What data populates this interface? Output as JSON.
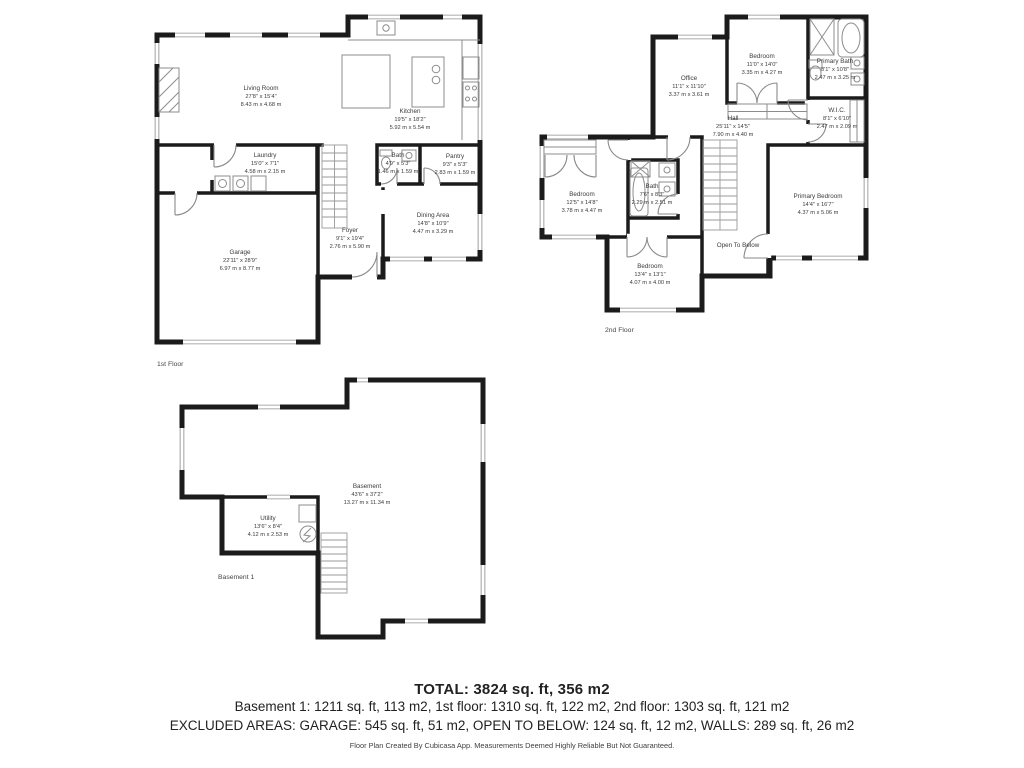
{
  "page": {
    "background": "#ffffff",
    "wall_color": "#1b1b1b",
    "fixture_color": "#8c8c8c",
    "text_color": "#3b3b3b"
  },
  "floors": {
    "first": {
      "label": "1st Floor",
      "rooms": {
        "living_room": {
          "name": "Living Room",
          "imperial": "27'8\" x 15'4\"",
          "metric": "8.43 m x 4.68 m"
        },
        "kitchen": {
          "name": "Kitchen",
          "imperial": "19'5\" x 18'2\"",
          "metric": "5.92 m x 5.54 m"
        },
        "laundry": {
          "name": "Laundry",
          "imperial": "15'0\" x 7'1\"",
          "metric": "4.58 m x 2.15 m"
        },
        "bath": {
          "name": "Bath",
          "imperial": "4'9\" x 5'3\"",
          "metric": "1.46 m x 1.59 m"
        },
        "pantry": {
          "name": "Pantry",
          "imperial": "9'3\" x 5'3\"",
          "metric": "2.83 m x 1.59 m"
        },
        "dining_area": {
          "name": "Dining Area",
          "imperial": "14'8\" x 10'9\"",
          "metric": "4.47 m x 3.29 m"
        },
        "foyer": {
          "name": "Foyer",
          "imperial": "9'1\" x 19'4\"",
          "metric": "2.76 m x 5.90 m"
        },
        "garage": {
          "name": "Garage",
          "imperial": "22'11\" x 28'9\"",
          "metric": "6.97 m x 8.77 m"
        }
      }
    },
    "second": {
      "label": "2nd Floor",
      "rooms": {
        "office": {
          "name": "Office",
          "imperial": "11'1\" x 11'10\"",
          "metric": "3.37 m x 3.61 m"
        },
        "bedroom_top": {
          "name": "Bedroom",
          "imperial": "11'0\" x 14'0\"",
          "metric": "3.35 m x 4.27 m"
        },
        "primary_bath": {
          "name": "Primary Bath",
          "imperial": "8'1\" x 10'8\"",
          "metric": "2.47 m x 3.25 m"
        },
        "wic": {
          "name": "W.I.C.",
          "imperial": "8'1\" x 6'10\"",
          "metric": "2.47 m x 2.09 m"
        },
        "hall": {
          "name": "Hall",
          "imperial": "25'11\" x 14'5\"",
          "metric": "7.90 m x 4.40 m"
        },
        "bedroom_left": {
          "name": "Bedroom",
          "imperial": "12'5\" x 14'8\"",
          "metric": "3.78 m x 4.47 m"
        },
        "bath": {
          "name": "Bath",
          "imperial": "7'6\" x 8'3\"",
          "metric": "2.29 m x 2.51 m"
        },
        "bedroom_bottom": {
          "name": "Bedroom",
          "imperial": "13'4\" x 13'1\"",
          "metric": "4.07 m x 4.00 m"
        },
        "primary_bedroom": {
          "name": "Primary Bedroom",
          "imperial": "14'4\" x 16'7\"",
          "metric": "4.37 m x 5.06 m"
        },
        "open_to_below": {
          "name": "Open To Below"
        }
      }
    },
    "basement": {
      "label": "Basement 1",
      "rooms": {
        "basement": {
          "name": "Basement",
          "imperial": "43'6\" x 37'2\"",
          "metric": "13.27 m x 11.34 m"
        },
        "utility": {
          "name": "Utility",
          "imperial": "13'6\" x 8'4\"",
          "metric": "4.12 m x 2.53 m"
        }
      }
    }
  },
  "summary": {
    "total": "TOTAL: 3824 sq. ft, 356 m2",
    "floors_line": "Basement 1: 1211 sq. ft, 113 m2, 1st floor: 1310 sq. ft, 122 m2, 2nd floor: 1303 sq. ft, 121 m2",
    "excluded_line": "EXCLUDED AREAS: GARAGE: 545 sq. ft, 51 m2, OPEN TO BELOW: 124 sq. ft, 12 m2, WALLS: 289 sq. ft, 26 m2",
    "disclaimer": "Floor Plan Created By Cubicasa App. Measurements Deemed Highly Reliable But Not Guaranteed."
  }
}
